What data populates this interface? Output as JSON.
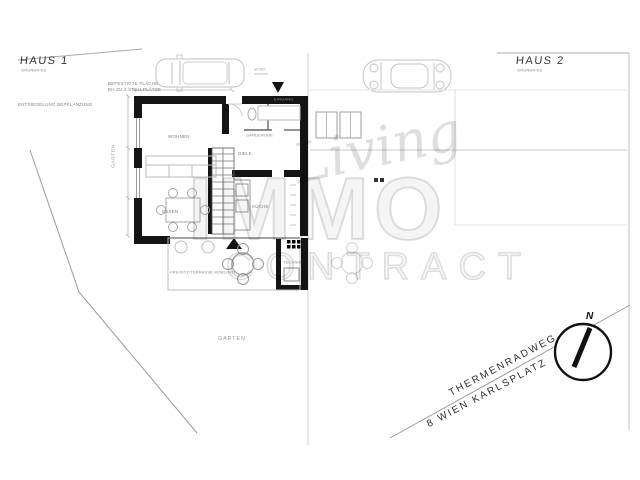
{
  "titles": {
    "haus1": {
      "title": "HAUS 1",
      "subtitle": "GRUNDRISS"
    },
    "haus2": {
      "title": "HAUS 2",
      "subtitle": "GRUNDRISS"
    }
  },
  "annotations": {
    "paved_line1": "BEFESTIGTE FLÄCHE",
    "paved_line2": "BH ZU 2 STELLPLÄTZE",
    "unsealing": "ENTSIEGELUNG BEPFLANZUNG",
    "level_mark": "±0,00",
    "terrace": "FREISITZ/TERRASSE MÖBLIERT",
    "garden_bottom": "GARTEN",
    "garden_left": "GARTEN"
  },
  "rooms": {
    "wohnen": "WOHNEN",
    "essen": "ESSEN",
    "kueche": "KÜCHE",
    "diele": "DIELE",
    "garderobe": "GARDEROBE",
    "technik": "TECHNIK",
    "eingang": "EINGANG"
  },
  "road": {
    "line1": "THERMENRADWEG",
    "line2": "8 WIEN KARLSPLATZ"
  },
  "compass": {
    "north": "N"
  },
  "watermark": {
    "script": "Living",
    "block": "IMMO",
    "outline": "CONTRACT"
  },
  "colors": {
    "wall": "#141414",
    "line_light": "#c4c4c4",
    "line_mid": "#8c8c8c",
    "text": "#555555",
    "watermark": "#d9d9d9"
  }
}
